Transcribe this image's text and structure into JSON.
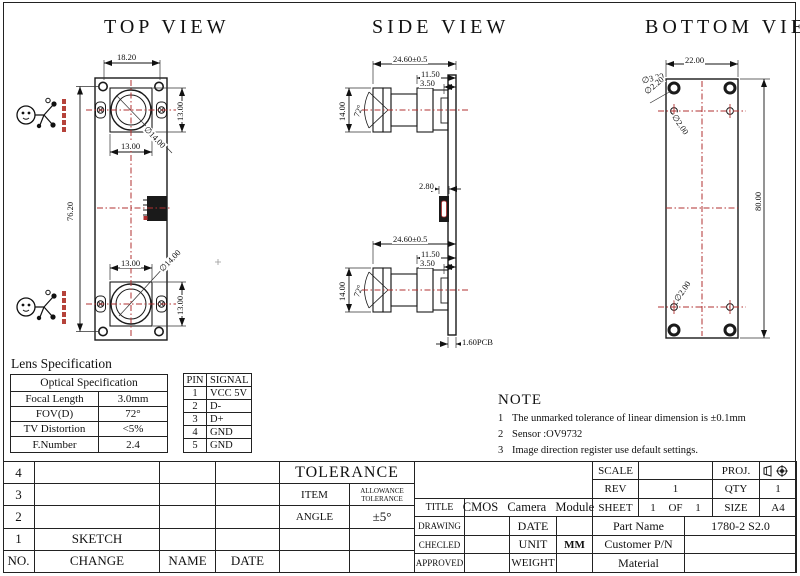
{
  "views": {
    "top": {
      "title": "TOP VIEW",
      "dims": {
        "hole_spacing": "18.20",
        "board_length": "76.20",
        "lens1_width": "13.00",
        "lens1_height": "13.00",
        "lens1_dia": "∅14.00",
        "lens2_width": "13.00",
        "lens2_height": "13.00",
        "lens2_dia": "∅14.00"
      }
    },
    "side": {
      "title": "SIDE VIEW",
      "dims": {
        "cam1_total": "24.60±0.5",
        "cam1_barrel": "11.50",
        "cam1_flange": "3.50",
        "cam1_height": "14.00",
        "cam1_fov": "72°",
        "usb_width": "2.80",
        "cam2_total": "24.60±0.5",
        "cam2_barrel": "11.50",
        "cam2_flange": "3.50",
        "cam2_height": "14.00",
        "cam2_fov": "72°",
        "pcb_thickness": "1.60PCB"
      }
    },
    "bottom": {
      "title": "BOTTOM VIEW",
      "dims": {
        "board_width": "22.00",
        "board_length": "80.00",
        "hole_dia_outer": "∅3.20",
        "hole_dia_inner": "∅2.20",
        "small_hole_top": "∅2.00",
        "small_hole_bottom": "∅2.00"
      }
    }
  },
  "lens_spec": {
    "title": "Lens Specification",
    "header": "Optical Specification",
    "rows": [
      {
        "label": "Focal Length",
        "value": "3.0mm"
      },
      {
        "label": "FOV(D)",
        "value": "72°"
      },
      {
        "label": "TV Distortion",
        "value": "<5%"
      },
      {
        "label": "F.Number",
        "value": "2.4"
      }
    ]
  },
  "pin_table": {
    "headers": {
      "pin": "PIN",
      "signal": "SIGNAL"
    },
    "rows": [
      {
        "pin": "1",
        "signal": "VCC 5V"
      },
      {
        "pin": "2",
        "signal": "D-"
      },
      {
        "pin": "3",
        "signal": "D+"
      },
      {
        "pin": "4",
        "signal": "GND"
      },
      {
        "pin": "5",
        "signal": "GND"
      }
    ]
  },
  "note": {
    "title": "NOTE",
    "items": [
      {
        "num": "1",
        "text": "The unmarked tolerance of linear dimension is ±0.1mm"
      },
      {
        "num": "2",
        "text": "Sensor :OV9732"
      },
      {
        "num": "3",
        "text": "Image direction register use default settings."
      }
    ]
  },
  "title_block": {
    "left": {
      "rev_rows": [
        "4",
        "3",
        "2",
        "1"
      ],
      "no_label": "NO.",
      "sketch_label": "SKETCH",
      "change_label": "CHANGE",
      "name_label": "NAME",
      "date_label": "DATE",
      "tolerance_label": "TOLERANCE",
      "item_label": "ITEM",
      "allowance_line1": "ALLOWANCE",
      "allowance_line2": "TOLERANCE",
      "angle_label": "ANGLE",
      "angle_value": "±5°"
    },
    "right": {
      "scale_label": "SCALE",
      "scale_value": "",
      "proj_label": "PROJ.",
      "rev_label": "REV",
      "rev_value": "1",
      "qty_label": "QTY",
      "qty_value": "1",
      "title_label": "TITLE",
      "title_value": "CMOS Camera Module",
      "sheet_label": "SHEET",
      "sheet_value": "1 OF 1",
      "size_label": "SIZE",
      "size_value": "A4",
      "drawing_label": "DRAWING",
      "date_label": "DATE",
      "part_name_label": "Part Name",
      "part_name_value": "1780-2 S2.0",
      "checked_label": "CHECLED",
      "unit_label": "UNIT",
      "unit_value": "MM",
      "customer_label": "Customer P/N",
      "approved_label": "APPROVED",
      "weight_label": "WEIGHT",
      "material_label": "Material"
    }
  },
  "colors": {
    "centerline_red": "#b03030",
    "line": "#1a1a1a"
  }
}
